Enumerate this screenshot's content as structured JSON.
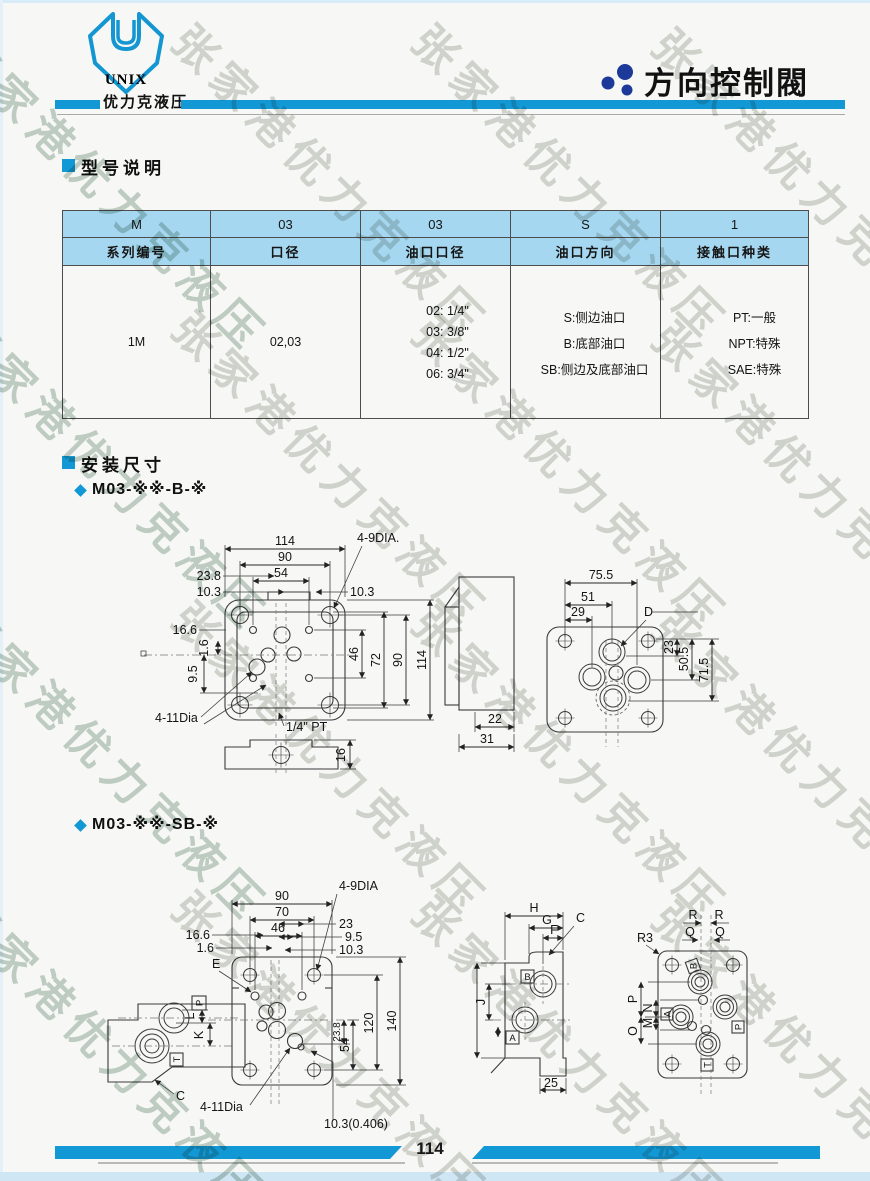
{
  "watermark": {
    "text": "张家港优力克液压"
  },
  "header": {
    "logo_text": "UNIX",
    "brand": "优力克液压",
    "title": "方向控制閥"
  },
  "sections": {
    "model": "型号说明",
    "mount": "安装尺寸",
    "variant_b": "M03-※※-B-※",
    "variant_sb": "M03-※※-SB-※"
  },
  "table": {
    "codes": [
      "M",
      "03",
      "03",
      "S",
      "1"
    ],
    "headers": [
      "系列编号",
      "口径",
      "油口口径",
      "油口方向",
      "接触口种类"
    ],
    "series": "1M",
    "bore": "02,03",
    "port_sizes": [
      "02: 1/4\"",
      "03: 3/8\"",
      "04: 1/2\"",
      "06: 3/4\""
    ],
    "port_directions": [
      "S:侧边油口",
      "B:底部油口",
      "SB:侧边及底部油口"
    ],
    "connection_types": [
      "PT:一般",
      "NPT:特殊",
      "SAE:特殊"
    ]
  },
  "d1": {
    "top_114": "114",
    "top_90": "90",
    "top_54": "54",
    "left_238": "23.8",
    "left_103": "10.3",
    "right_103": "10.3",
    "callout_9dia": "4-9DIA.",
    "left_166": "16.6",
    "left_16": "1.6",
    "left_95": "9.5",
    "r_46": "46",
    "r_72": "72",
    "r_90": "90",
    "r_114": "114",
    "callout_11dia": "4-11Dia",
    "port": "1/4\" PT",
    "side_22": "22",
    "side_31": "31",
    "bottom_16": "16"
  },
  "d1r": {
    "top_755": "75.5",
    "top_51": "51",
    "top_29": "29",
    "callout_d": "D",
    "r_23": "23",
    "r_505": "50.5",
    "r_715": "71.5"
  },
  "d2": {
    "top_90": "90",
    "top_70": "70",
    "top_46": "46",
    "r_23": "23",
    "r_95": "9.5",
    "r_103": "10.3",
    "left_166": "16.6",
    "left_16": "1.6",
    "callout_e": "E",
    "callout_9dia": "4-9DIA",
    "r_54": "54",
    "r_120": "120",
    "r_140": "140",
    "r_238": "23.8",
    "callout_11dia": "4-11Dia",
    "bottom_103": "10.3(0.406)"
  },
  "d2s": {
    "port_p": "P",
    "port_t": "T",
    "dim_l": "L",
    "dim_k": "K",
    "callout_c": "C"
  },
  "d2m": {
    "dim_h": "H",
    "dim_g": "G",
    "dim_f": "F",
    "callout_c": "C",
    "port_b": "B",
    "port_a": "A",
    "dim_j": "J",
    "dim_25": "25"
  },
  "d2r": {
    "callout_r3": "R3",
    "dim_r": "R",
    "dim_r2": "R",
    "dim_q": "Q",
    "dim_q2": "Q",
    "port_b": "B",
    "port_a": "A",
    "port_p": "P",
    "port_t": "T",
    "dim_p": "P",
    "dim_n": "N",
    "dim_o": "O",
    "dim_m": "M"
  },
  "footer": {
    "page": "114"
  },
  "colors": {
    "accent": "#1398d6",
    "table_header_bg": "#a6d7f0",
    "title_dot": "#1d3a9b"
  }
}
